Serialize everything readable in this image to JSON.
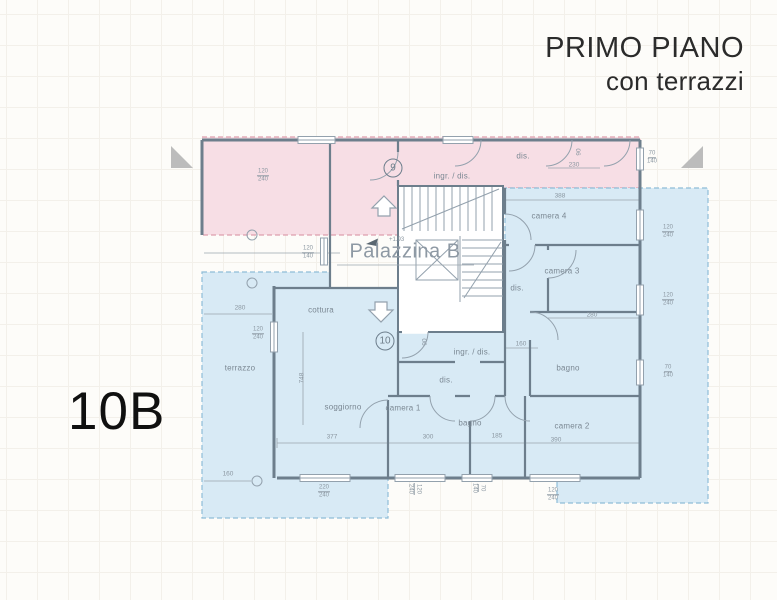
{
  "header": {
    "title_line1": "PRIMO PIANO",
    "title_line2": "con terrazzi"
  },
  "unit_tag": "10B",
  "plan": {
    "building_label": "Palazzina B",
    "level_marker": "+1.93",
    "unit_badges": [
      {
        "text": "9",
        "x": 393,
        "y": 168
      },
      {
        "text": "10",
        "x": 385,
        "y": 341
      }
    ],
    "room_labels": [
      {
        "text": "ingr. / dis.",
        "x": 452,
        "y": 176
      },
      {
        "text": "dis.",
        "x": 523,
        "y": 156
      },
      {
        "text": "camera 4",
        "x": 549,
        "y": 216
      },
      {
        "text": "dis.",
        "x": 517,
        "y": 288
      },
      {
        "text": "camera 3",
        "x": 562,
        "y": 271
      },
      {
        "text": "bagno",
        "x": 568,
        "y": 368
      },
      {
        "text": "camera 2",
        "x": 572,
        "y": 426
      },
      {
        "text": "ingr. / dis.",
        "x": 472,
        "y": 352
      },
      {
        "text": "dis.",
        "x": 446,
        "y": 380
      },
      {
        "text": "bagno",
        "x": 470,
        "y": 423
      },
      {
        "text": "camera 1",
        "x": 403,
        "y": 408
      },
      {
        "text": "soggiorno",
        "x": 343,
        "y": 407
      },
      {
        "text": "cottura",
        "x": 321,
        "y": 310
      },
      {
        "text": "terrazzo",
        "x": 240,
        "y": 368
      }
    ],
    "window_dims": [
      {
        "top": "120",
        "bottom": "240",
        "x": 263,
        "y": 176,
        "rot": 0
      },
      {
        "top": "70",
        "bottom": "140",
        "x": 652,
        "y": 158,
        "rot": 0
      },
      {
        "top": "120",
        "bottom": "240",
        "x": 668,
        "y": 232,
        "rot": 0
      },
      {
        "top": "120",
        "bottom": "240",
        "x": 668,
        "y": 300,
        "rot": 0
      },
      {
        "top": "70",
        "bottom": "140",
        "x": 668,
        "y": 372,
        "rot": 0
      },
      {
        "top": "120",
        "bottom": "140",
        "x": 308,
        "y": 253,
        "rot": 0
      },
      {
        "top": "120",
        "bottom": "240",
        "x": 258,
        "y": 334,
        "rot": 0
      },
      {
        "top": "220",
        "bottom": "240",
        "x": 324,
        "y": 492,
        "rot": 0
      },
      {
        "top": "120",
        "bottom": "240",
        "x": 414,
        "y": 489,
        "rot": 90
      },
      {
        "top": "70",
        "bottom": "140",
        "x": 478,
        "y": 488,
        "rot": 90
      },
      {
        "top": "120",
        "bottom": "240",
        "x": 553,
        "y": 495,
        "rot": 0
      }
    ],
    "linear_dims": [
      {
        "text": "280",
        "x": 240,
        "y": 308,
        "rot": 0
      },
      {
        "text": "160",
        "x": 228,
        "y": 474,
        "rot": 0
      },
      {
        "text": "748",
        "x": 302,
        "y": 378,
        "rot": -90
      },
      {
        "text": "377",
        "x": 332,
        "y": 437,
        "rot": 0
      },
      {
        "text": "300",
        "x": 428,
        "y": 437,
        "rot": 0
      },
      {
        "text": "185",
        "x": 497,
        "y": 436,
        "rot": 0
      },
      {
        "text": "390",
        "x": 556,
        "y": 440,
        "rot": 0
      },
      {
        "text": "280",
        "x": 592,
        "y": 315,
        "rot": 0
      },
      {
        "text": "388",
        "x": 560,
        "y": 196,
        "rot": 0
      },
      {
        "text": "230",
        "x": 574,
        "y": 165,
        "rot": 0
      },
      {
        "text": "160",
        "x": 521,
        "y": 344,
        "rot": 0
      },
      {
        "text": "90",
        "x": 579,
        "y": 152,
        "rot": -90
      },
      {
        "text": "90",
        "x": 425,
        "y": 342,
        "rot": -90
      }
    ]
  },
  "colors": {
    "wall_line": "#6d7e8c",
    "thin_line": "#93a1ad",
    "dim_line": "#9aa5ae",
    "dim_text": "#8b97a1",
    "room_text": "#7b8893",
    "pink_fill": "#f7dee5",
    "pink_border": "#dd9fae",
    "blue_fill": "#d8eaf5",
    "blue_border": "#8fbdd8",
    "title_text": "#2b2b2b",
    "unit_text": "#101010",
    "palazzina_text": "#8e99a4"
  }
}
